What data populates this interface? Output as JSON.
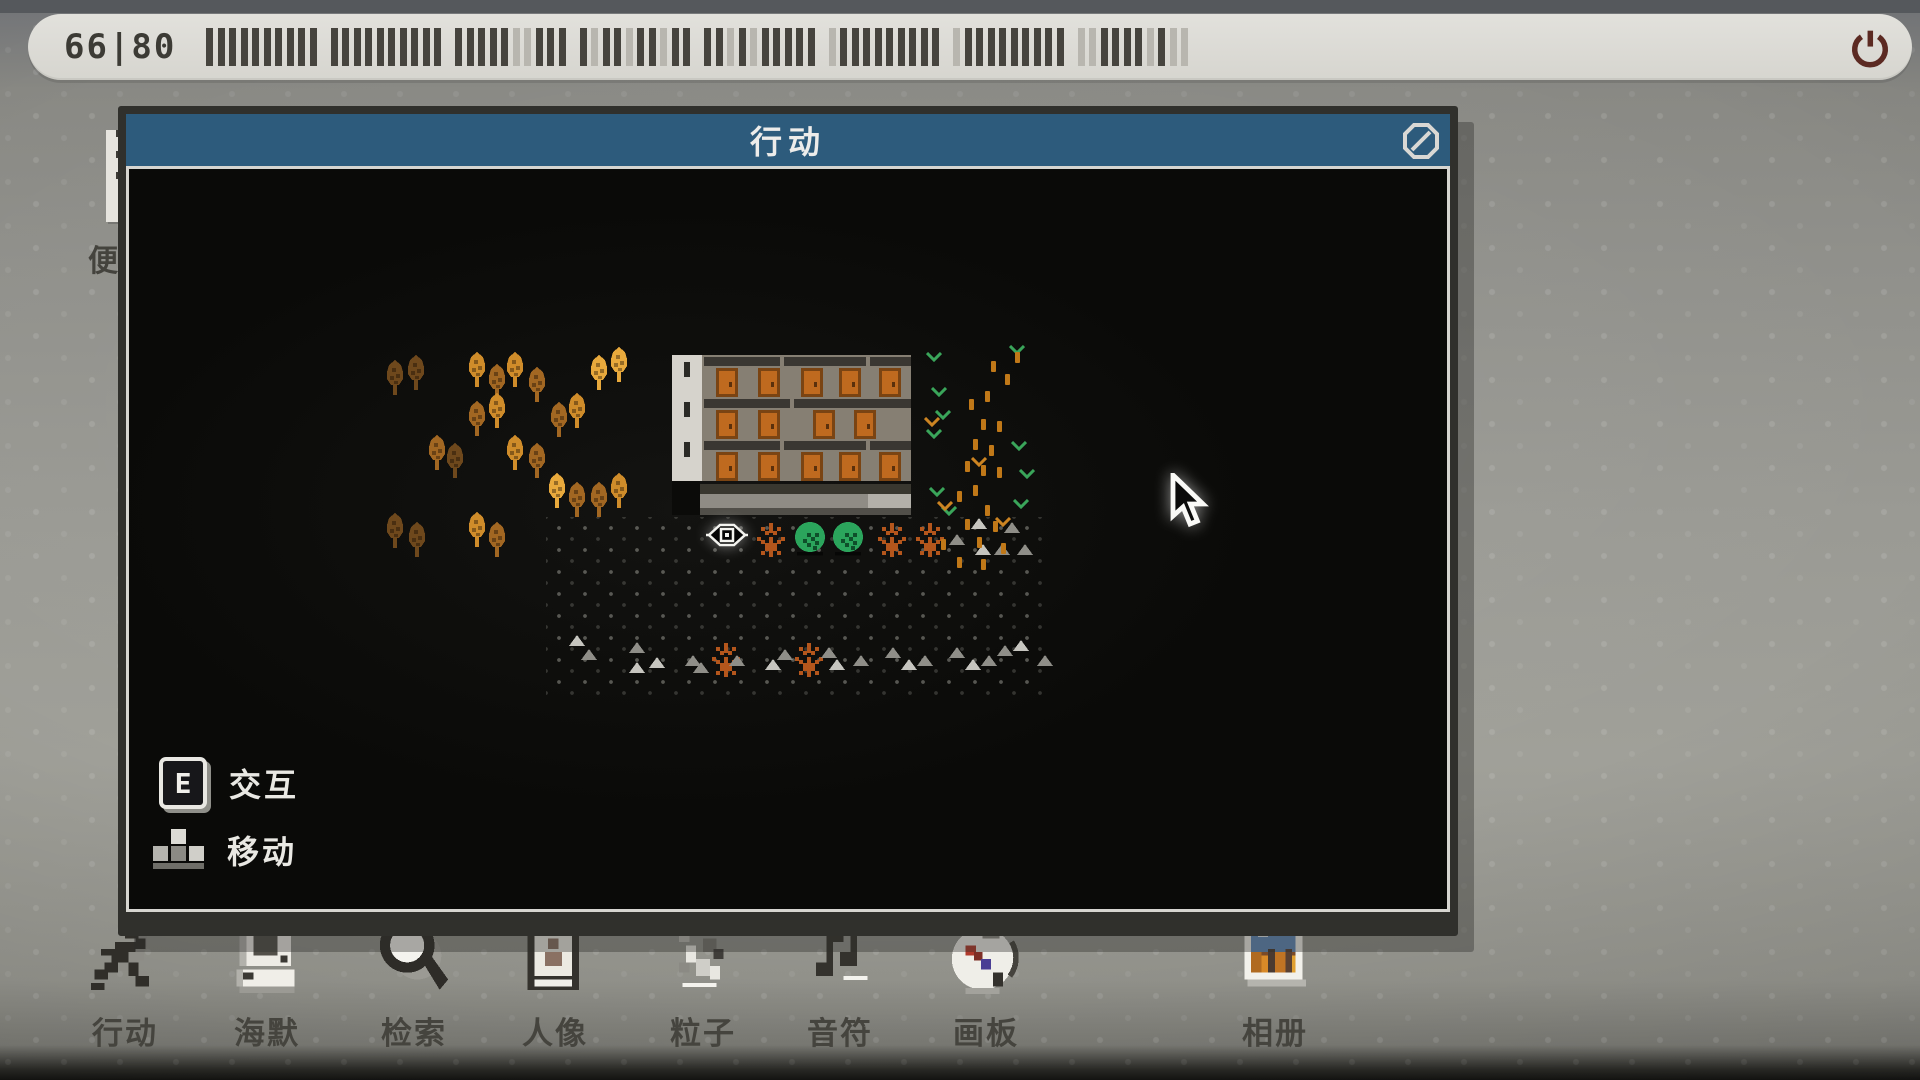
{
  "top_bar": {
    "counter": "66|80",
    "total_bars": 80,
    "filled_bars": 66,
    "bar_pattern": "11111111111111111111111110011110110110111101011111011111111101111111110011110100",
    "power_icon": "power-icon"
  },
  "memo_icon": {
    "label": "便签"
  },
  "window": {
    "title": "行动",
    "close_icon": "block-icon"
  },
  "legend": {
    "interact_key": "E",
    "interact_label": "交互",
    "move_label": "移动"
  },
  "dock": {
    "items": [
      {
        "id": "action",
        "label": "行动",
        "icon": "running-man-icon"
      },
      {
        "id": "haimo",
        "label": "海默",
        "icon": "computer-icon"
      },
      {
        "id": "search",
        "label": "检索",
        "icon": "magnifier-icon"
      },
      {
        "id": "portrait",
        "label": "人像",
        "icon": "portrait-icon"
      },
      {
        "id": "particle",
        "label": "粒子",
        "icon": "particles-icon"
      },
      {
        "id": "note",
        "label": "音符",
        "icon": "music-note-icon"
      },
      {
        "id": "board",
        "label": "画板",
        "icon": "palette-icon"
      },
      {
        "id": "album",
        "label": "相册",
        "icon": "photo-icon"
      }
    ]
  },
  "colors": {
    "title_blue": "#2d5b7c",
    "bar_dark": "#46443e",
    "bar_light": "#b8b6af",
    "power_red": "#5c2a22",
    "text_dark": "#3c3b35",
    "door_orange": "#bf6a1f",
    "bush_green": "#2ba55c",
    "dash_orange": "#c07818",
    "chev_green": "#3aa55a",
    "chev_orange": "#cc8422",
    "bare_orange": "#b4561c",
    "rock_light": "#c6c5bf",
    "rock_dim": "#8f8e88"
  },
  "map": {
    "palette": {
      "b": "#cf8c2a",
      "m": "#a26722",
      "d": "#6e481c",
      "y": "#e8a93c"
    },
    "trees": [
      [
        255,
        191,
        "d"
      ],
      [
        276,
        186,
        "d"
      ],
      [
        337,
        183,
        "b"
      ],
      [
        357,
        195,
        "m"
      ],
      [
        375,
        183,
        "b"
      ],
      [
        397,
        198,
        "m"
      ],
      [
        459,
        186,
        "y"
      ],
      [
        479,
        178,
        "y"
      ],
      [
        337,
        232,
        "m"
      ],
      [
        357,
        224,
        "b"
      ],
      [
        419,
        233,
        "m"
      ],
      [
        437,
        224,
        "b"
      ],
      [
        297,
        266,
        "m"
      ],
      [
        315,
        274,
        "d"
      ],
      [
        375,
        266,
        "b"
      ],
      [
        397,
        274,
        "m"
      ],
      [
        417,
        304,
        "y"
      ],
      [
        437,
        313,
        "m"
      ],
      [
        459,
        313,
        "m"
      ],
      [
        479,
        304,
        "b"
      ],
      [
        255,
        344,
        "d"
      ],
      [
        277,
        353,
        "d"
      ],
      [
        337,
        343,
        "b"
      ],
      [
        357,
        353,
        "m"
      ]
    ],
    "bare_trees": [
      [
        624,
        350
      ],
      [
        745,
        350
      ],
      [
        783,
        350
      ],
      [
        579,
        470
      ],
      [
        662,
        470
      ]
    ],
    "bushes": [
      [
        662,
        352
      ],
      [
        700,
        352
      ]
    ],
    "eye": {
      "x": 577,
      "y": 351
    },
    "rocks": [
      [
        842,
        349
      ],
      [
        875,
        353
      ],
      [
        820,
        365
      ],
      [
        846,
        375
      ],
      [
        865,
        375
      ],
      [
        888,
        375
      ],
      [
        440,
        466
      ],
      [
        452,
        480
      ],
      [
        500,
        473
      ],
      [
        520,
        488
      ],
      [
        556,
        486
      ],
      [
        600,
        486
      ],
      [
        636,
        490
      ],
      [
        648,
        480
      ],
      [
        692,
        478
      ],
      [
        700,
        490
      ],
      [
        724,
        486
      ],
      [
        756,
        478
      ],
      [
        772,
        490
      ],
      [
        788,
        486
      ],
      [
        820,
        478
      ],
      [
        836,
        490
      ],
      [
        852,
        486
      ],
      [
        868,
        476
      ],
      [
        884,
        471
      ],
      [
        908,
        486
      ],
      [
        564,
        493
      ],
      [
        500,
        493
      ]
    ],
    "chevrons": [
      [
        797,
        183,
        "g"
      ],
      [
        802,
        218,
        "g"
      ],
      [
        806,
        241,
        "g"
      ],
      [
        797,
        260,
        "g"
      ],
      [
        800,
        318,
        "g"
      ],
      [
        812,
        337,
        "g"
      ],
      [
        880,
        176,
        "g"
      ],
      [
        882,
        272,
        "g"
      ],
      [
        890,
        300,
        "g"
      ],
      [
        884,
        330,
        "g"
      ],
      [
        795,
        248,
        "o"
      ],
      [
        842,
        288,
        "o"
      ],
      [
        808,
        332,
        "o"
      ],
      [
        866,
        348,
        "o"
      ]
    ],
    "dashes": [
      [
        862,
        192
      ],
      [
        886,
        183
      ],
      [
        876,
        205
      ],
      [
        856,
        222
      ],
      [
        840,
        230
      ],
      [
        852,
        250
      ],
      [
        868,
        252
      ],
      [
        844,
        270
      ],
      [
        860,
        276
      ],
      [
        836,
        292
      ],
      [
        852,
        296
      ],
      [
        868,
        298
      ],
      [
        844,
        316
      ],
      [
        828,
        322
      ],
      [
        856,
        336
      ],
      [
        836,
        350
      ],
      [
        864,
        352
      ],
      [
        848,
        368
      ],
      [
        812,
        370
      ],
      [
        872,
        374
      ],
      [
        828,
        388
      ],
      [
        852,
        390
      ]
    ],
    "dot_field": {
      "x": 417,
      "y": 348,
      "w": 505,
      "h": 178
    },
    "cursor": {
      "x": 1038,
      "y": 304
    }
  }
}
